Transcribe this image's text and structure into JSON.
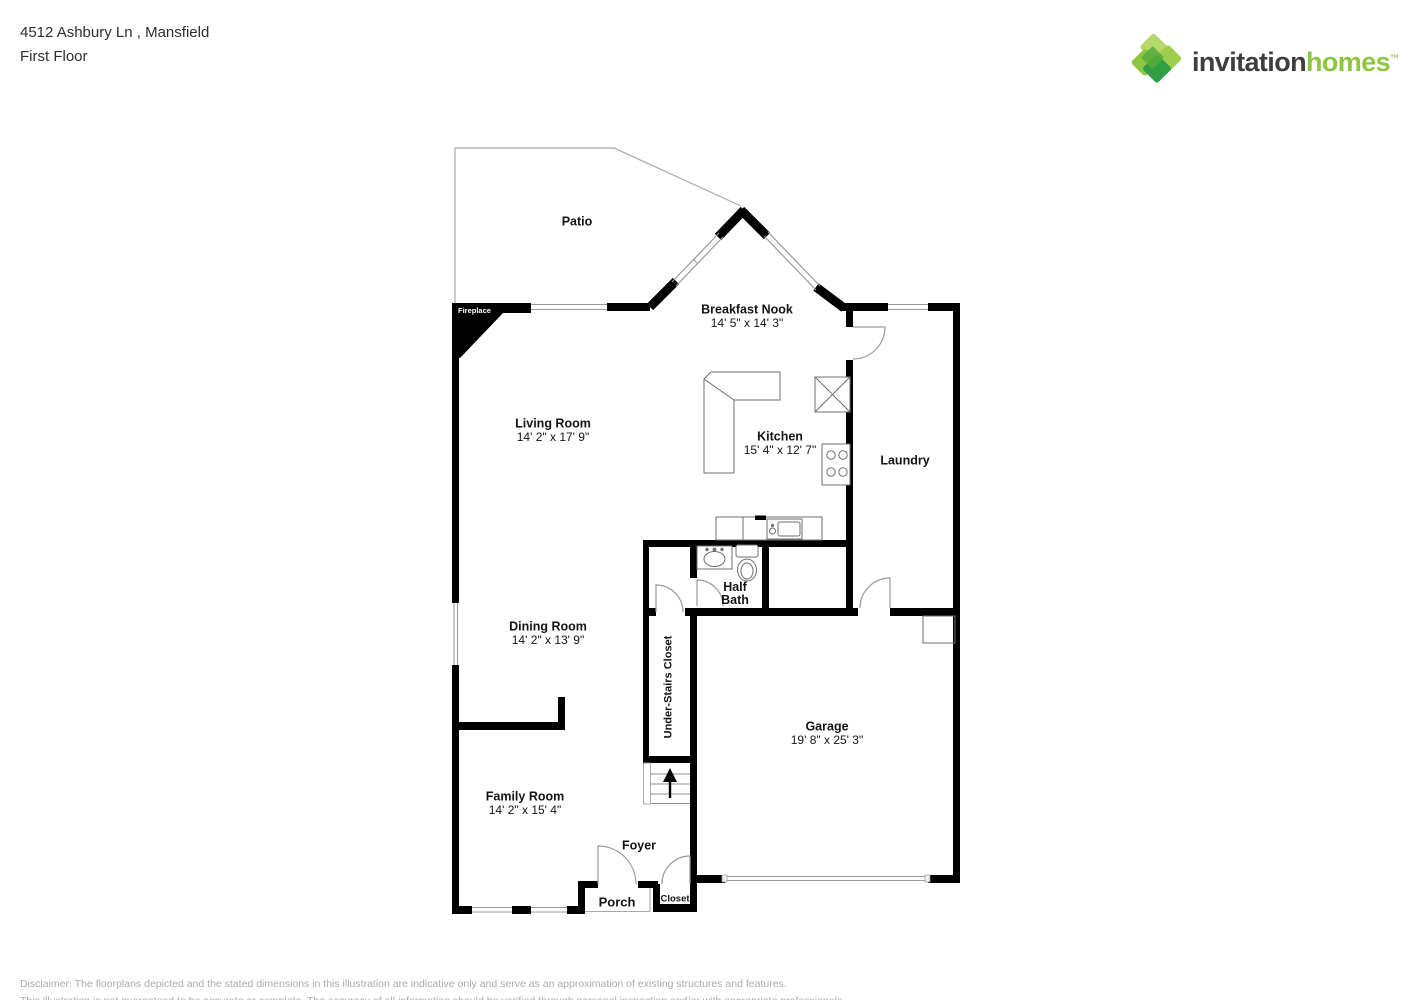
{
  "header": {
    "address": "4512 Ashbury Ln , Mansfield",
    "floor": "First Floor"
  },
  "logo": {
    "brand_primary": "invitation",
    "brand_secondary": "homes",
    "trademark": "™",
    "primary_color": "#3e3e3e",
    "secondary_color": "#8dc63f",
    "diamond_colors": [
      "#b6d76a",
      "#9fce4e",
      "#8cc63e",
      "#2f9e44"
    ]
  },
  "floorplan": {
    "wall_color": "#000000",
    "fireplace_label": "Fireplace",
    "rooms": [
      {
        "id": "patio",
        "name": "Patio",
        "dims": ""
      },
      {
        "id": "breakfast-nook",
        "name": "Breakfast Nook",
        "dims": "14' 5\" x 14' 3\""
      },
      {
        "id": "living-room",
        "name": "Living Room",
        "dims": "14' 2\" x 17' 9\""
      },
      {
        "id": "kitchen",
        "name": "Kitchen",
        "dims": "15' 4\" x 12' 7\""
      },
      {
        "id": "laundry",
        "name": "Laundry",
        "dims": ""
      },
      {
        "id": "half-bath",
        "name": "Half Bath",
        "dims": ""
      },
      {
        "id": "dining-room",
        "name": "Dining Room",
        "dims": "14' 2\" x 13' 9\""
      },
      {
        "id": "under-stairs-closet",
        "name": "Under-Stairs Closet",
        "dims": ""
      },
      {
        "id": "garage",
        "name": "Garage",
        "dims": "19' 8\" x 25' 3\""
      },
      {
        "id": "family-room",
        "name": "Family Room",
        "dims": "14' 2\" x 15' 4\""
      },
      {
        "id": "foyer",
        "name": "Foyer",
        "dims": ""
      },
      {
        "id": "porch",
        "name": "Porch",
        "dims": ""
      },
      {
        "id": "closet",
        "name": "Closet",
        "dims": ""
      }
    ]
  },
  "footer": {
    "disclaimer_line1": "Disclaimer: The floorplans depicted and the stated dimensions in this illustration are indicative only and serve as an approximation of existing structures and features.",
    "disclaimer_line2": "This illustration is not guaranteed to be accurate or complete. The accuracy of all information should be verified through personal inspection and/or with appropriate professionals."
  }
}
